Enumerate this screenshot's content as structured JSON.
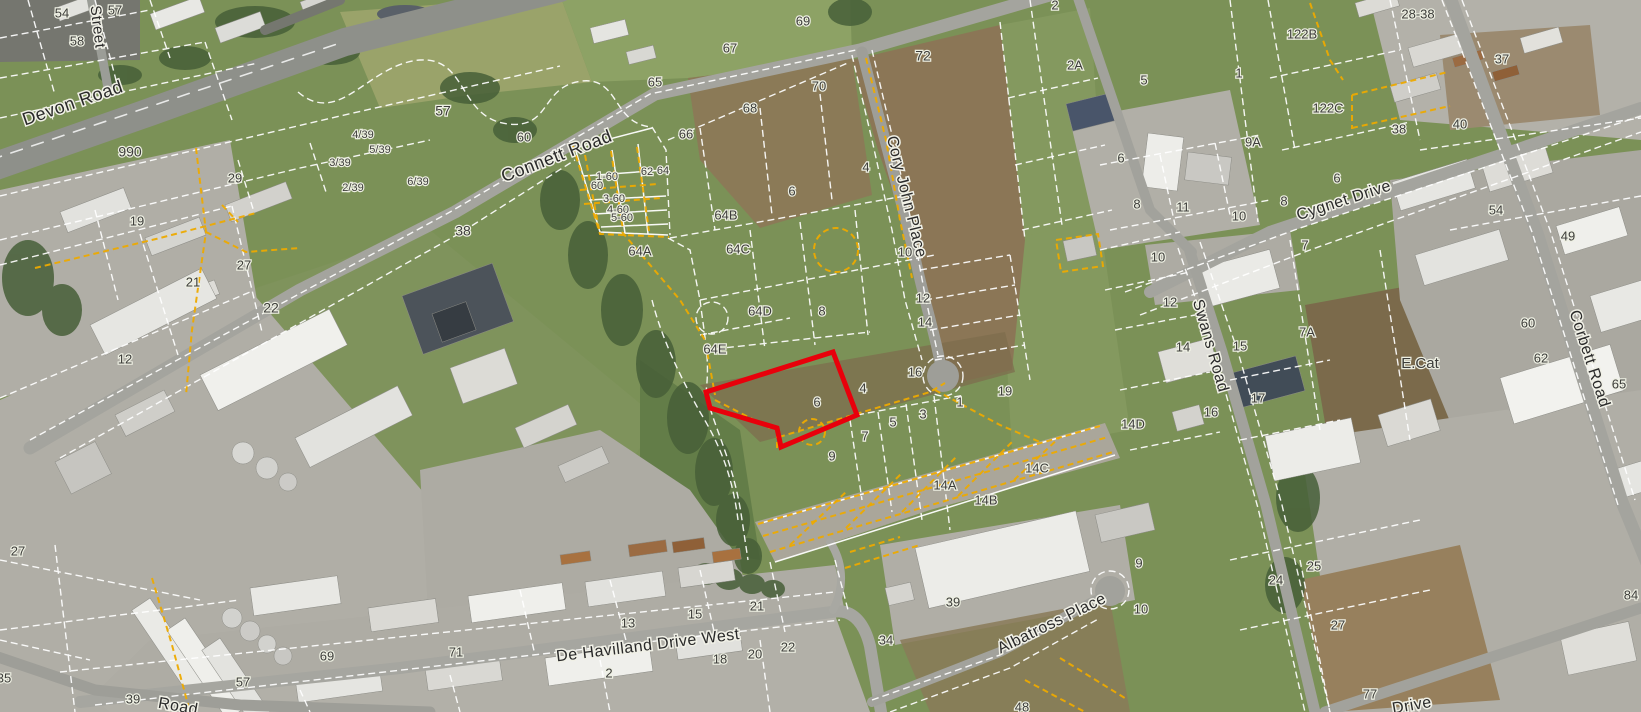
{
  "map": {
    "type": "cadastral-aerial-map",
    "colors": {
      "highlight": "#e8000b",
      "parcel_line": "#ffffff",
      "utility_line": "#edaa00",
      "road_label": "#2a2a2a",
      "parcel_label": "#3d3d3a"
    },
    "highlighted_parcel": {
      "label": "6",
      "points": "706,392 833,352 857,415 781,447 777,428 710,408"
    },
    "road_labels": [
      {
        "t": "Street",
        "x": 97,
        "y": 27,
        "r": 83,
        "s": 15
      },
      {
        "t": "Devon Road",
        "x": 73,
        "y": 104,
        "r": -19,
        "s": 18
      },
      {
        "t": "Connett Road",
        "x": 557,
        "y": 157,
        "r": -21,
        "s": 18
      },
      {
        "t": "Cory John Place",
        "x": 906,
        "y": 197,
        "r": 76,
        "s": 16
      },
      {
        "t": "Cygnet Drive",
        "x": 1344,
        "y": 201,
        "r": -18,
        "s": 16
      },
      {
        "t": "Swans Road",
        "x": 1210,
        "y": 346,
        "r": 74,
        "s": 16
      },
      {
        "t": "Corbett Road",
        "x": 1589,
        "y": 359,
        "r": 72,
        "s": 16
      },
      {
        "t": "De Havilland Drive West",
        "x": 648,
        "y": 646,
        "r": -7,
        "s": 16
      },
      {
        "t": "Albatross Place",
        "x": 1052,
        "y": 624,
        "r": -26,
        "s": 16
      },
      {
        "t": "Drive",
        "x": 1412,
        "y": 706,
        "r": -10,
        "s": 16
      },
      {
        "t": "Road",
        "x": 178,
        "y": 707,
        "r": 10,
        "s": 16
      }
    ],
    "parcel_labels": [
      {
        "t": "54",
        "x": 62,
        "y": 14
      },
      {
        "t": "57",
        "x": 115,
        "y": 11
      },
      {
        "t": "58",
        "x": 77,
        "y": 42
      },
      {
        "t": "990",
        "x": 130,
        "y": 153,
        "s": 14
      },
      {
        "t": "29",
        "x": 235,
        "y": 179
      },
      {
        "t": "19",
        "x": 137,
        "y": 222
      },
      {
        "t": "27",
        "x": 244,
        "y": 266
      },
      {
        "t": "21",
        "x": 193,
        "y": 283
      },
      {
        "t": "22",
        "x": 271,
        "y": 309,
        "s": 14
      },
      {
        "t": "12",
        "x": 125,
        "y": 360
      },
      {
        "t": "4/39",
        "x": 363,
        "y": 135,
        "s": 11
      },
      {
        "t": "5/39",
        "x": 380,
        "y": 150,
        "s": 11
      },
      {
        "t": "3/39",
        "x": 340,
        "y": 163,
        "s": 11
      },
      {
        "t": "2/39",
        "x": 353,
        "y": 188,
        "s": 11
      },
      {
        "t": "6/39",
        "x": 418,
        "y": 182,
        "s": 11
      },
      {
        "t": "57",
        "x": 443,
        "y": 112,
        "s": 14
      },
      {
        "t": "38",
        "x": 463,
        "y": 232,
        "s": 14
      },
      {
        "t": "60",
        "x": 524,
        "y": 138
      },
      {
        "t": "1-60",
        "x": 607,
        "y": 177,
        "s": 11
      },
      {
        "t": "60",
        "x": 597,
        "y": 186,
        "s": 11
      },
      {
        "t": "3-60",
        "x": 614,
        "y": 199,
        "s": 11
      },
      {
        "t": "4-60",
        "x": 618,
        "y": 210,
        "s": 11
      },
      {
        "t": "5-60",
        "x": 622,
        "y": 218,
        "s": 11
      },
      {
        "t": "62",
        "x": 647,
        "y": 172,
        "s": 11
      },
      {
        "t": "64",
        "x": 663,
        "y": 171,
        "s": 11
      },
      {
        "t": "65",
        "x": 655,
        "y": 83
      },
      {
        "t": "66",
        "x": 686,
        "y": 135
      },
      {
        "t": "68",
        "x": 750,
        "y": 109
      },
      {
        "t": "70",
        "x": 819,
        "y": 87
      },
      {
        "t": "72",
        "x": 923,
        "y": 57,
        "s": 14
      },
      {
        "t": "69",
        "x": 803,
        "y": 22
      },
      {
        "t": "67",
        "x": 730,
        "y": 49
      },
      {
        "t": "64A",
        "x": 640,
        "y": 252
      },
      {
        "t": "64B",
        "x": 726,
        "y": 216
      },
      {
        "t": "64C",
        "x": 738,
        "y": 250
      },
      {
        "t": "64D",
        "x": 760,
        "y": 312
      },
      {
        "t": "64E",
        "x": 715,
        "y": 350
      },
      {
        "t": "6",
        "x": 792,
        "y": 192
      },
      {
        "t": "4",
        "x": 866,
        "y": 168
      },
      {
        "t": "8",
        "x": 822,
        "y": 312
      },
      {
        "t": "10",
        "x": 905,
        "y": 253
      },
      {
        "t": "12",
        "x": 923,
        "y": 299
      },
      {
        "t": "14",
        "x": 925,
        "y": 323
      },
      {
        "t": "16",
        "x": 915,
        "y": 373
      },
      {
        "t": "19",
        "x": 1005,
        "y": 392
      },
      {
        "t": "4",
        "x": 863,
        "y": 389
      },
      {
        "t": "6",
        "x": 817,
        "y": 403
      },
      {
        "t": "1",
        "x": 960,
        "y": 403
      },
      {
        "t": "3",
        "x": 923,
        "y": 415
      },
      {
        "t": "5",
        "x": 893,
        "y": 423
      },
      {
        "t": "7",
        "x": 865,
        "y": 437
      },
      {
        "t": "9",
        "x": 832,
        "y": 457
      },
      {
        "t": "2",
        "x": 1055,
        "y": 6
      },
      {
        "t": "2A",
        "x": 1075,
        "y": 66
      },
      {
        "t": "5",
        "x": 1144,
        "y": 81
      },
      {
        "t": "1",
        "x": 1239,
        "y": 74
      },
      {
        "t": "122B",
        "x": 1302,
        "y": 35
      },
      {
        "t": "122C",
        "x": 1328,
        "y": 109
      },
      {
        "t": "9A",
        "x": 1253,
        "y": 143
      },
      {
        "t": "6",
        "x": 1121,
        "y": 159
      },
      {
        "t": "6",
        "x": 1337,
        "y": 179
      },
      {
        "t": "8",
        "x": 1284,
        "y": 202
      },
      {
        "t": "8",
        "x": 1137,
        "y": 205
      },
      {
        "t": "11",
        "x": 1183,
        "y": 208
      },
      {
        "t": "10",
        "x": 1239,
        "y": 217
      },
      {
        "t": "7",
        "x": 1305,
        "y": 246
      },
      {
        "t": "28-38",
        "x": 1418,
        "y": 15
      },
      {
        "t": "37",
        "x": 1502,
        "y": 60
      },
      {
        "t": "38",
        "x": 1399,
        "y": 130
      },
      {
        "t": "40",
        "x": 1460,
        "y": 125
      },
      {
        "t": "54",
        "x": 1496,
        "y": 211
      },
      {
        "t": "49",
        "x": 1568,
        "y": 237
      },
      {
        "t": "10",
        "x": 1158,
        "y": 258
      },
      {
        "t": "12",
        "x": 1170,
        "y": 303
      },
      {
        "t": "7A",
        "x": 1307,
        "y": 333
      },
      {
        "t": "15",
        "x": 1240,
        "y": 347
      },
      {
        "t": "14",
        "x": 1183,
        "y": 348
      },
      {
        "t": "17",
        "x": 1258,
        "y": 399
      },
      {
        "t": "16",
        "x": 1211,
        "y": 413
      },
      {
        "t": "14D",
        "x": 1133,
        "y": 425
      },
      {
        "t": "60",
        "x": 1528,
        "y": 324
      },
      {
        "t": "62",
        "x": 1541,
        "y": 359
      },
      {
        "t": "65",
        "x": 1619,
        "y": 385
      },
      {
        "t": "E.Cat",
        "x": 1420,
        "y": 364,
        "s": 15
      },
      {
        "t": "14A",
        "x": 945,
        "y": 486
      },
      {
        "t": "14B",
        "x": 986,
        "y": 501
      },
      {
        "t": "14C",
        "x": 1037,
        "y": 469
      },
      {
        "t": "21",
        "x": 757,
        "y": 607
      },
      {
        "t": "15",
        "x": 695,
        "y": 615
      },
      {
        "t": "13",
        "x": 628,
        "y": 624
      },
      {
        "t": "18",
        "x": 720,
        "y": 660
      },
      {
        "t": "20",
        "x": 755,
        "y": 655
      },
      {
        "t": "22",
        "x": 788,
        "y": 648
      },
      {
        "t": "2",
        "x": 609,
        "y": 674
      },
      {
        "t": "71",
        "x": 456,
        "y": 653
      },
      {
        "t": "39",
        "x": 953,
        "y": 603
      },
      {
        "t": "34",
        "x": 886,
        "y": 641
      },
      {
        "t": "9",
        "x": 1139,
        "y": 564
      },
      {
        "t": "10",
        "x": 1141,
        "y": 610
      },
      {
        "t": "48",
        "x": 1022,
        "y": 708
      },
      {
        "t": "24",
        "x": 1276,
        "y": 581
      },
      {
        "t": "25",
        "x": 1314,
        "y": 567
      },
      {
        "t": "27",
        "x": 1338,
        "y": 626
      },
      {
        "t": "77",
        "x": 1370,
        "y": 695
      },
      {
        "t": "84",
        "x": 1631,
        "y": 596
      },
      {
        "t": "27",
        "x": 18,
        "y": 552
      },
      {
        "t": "35",
        "x": 4,
        "y": 679
      },
      {
        "t": "69",
        "x": 327,
        "y": 657
      },
      {
        "t": "57",
        "x": 243,
        "y": 683
      },
      {
        "t": "39",
        "x": 133,
        "y": 700
      }
    ]
  }
}
